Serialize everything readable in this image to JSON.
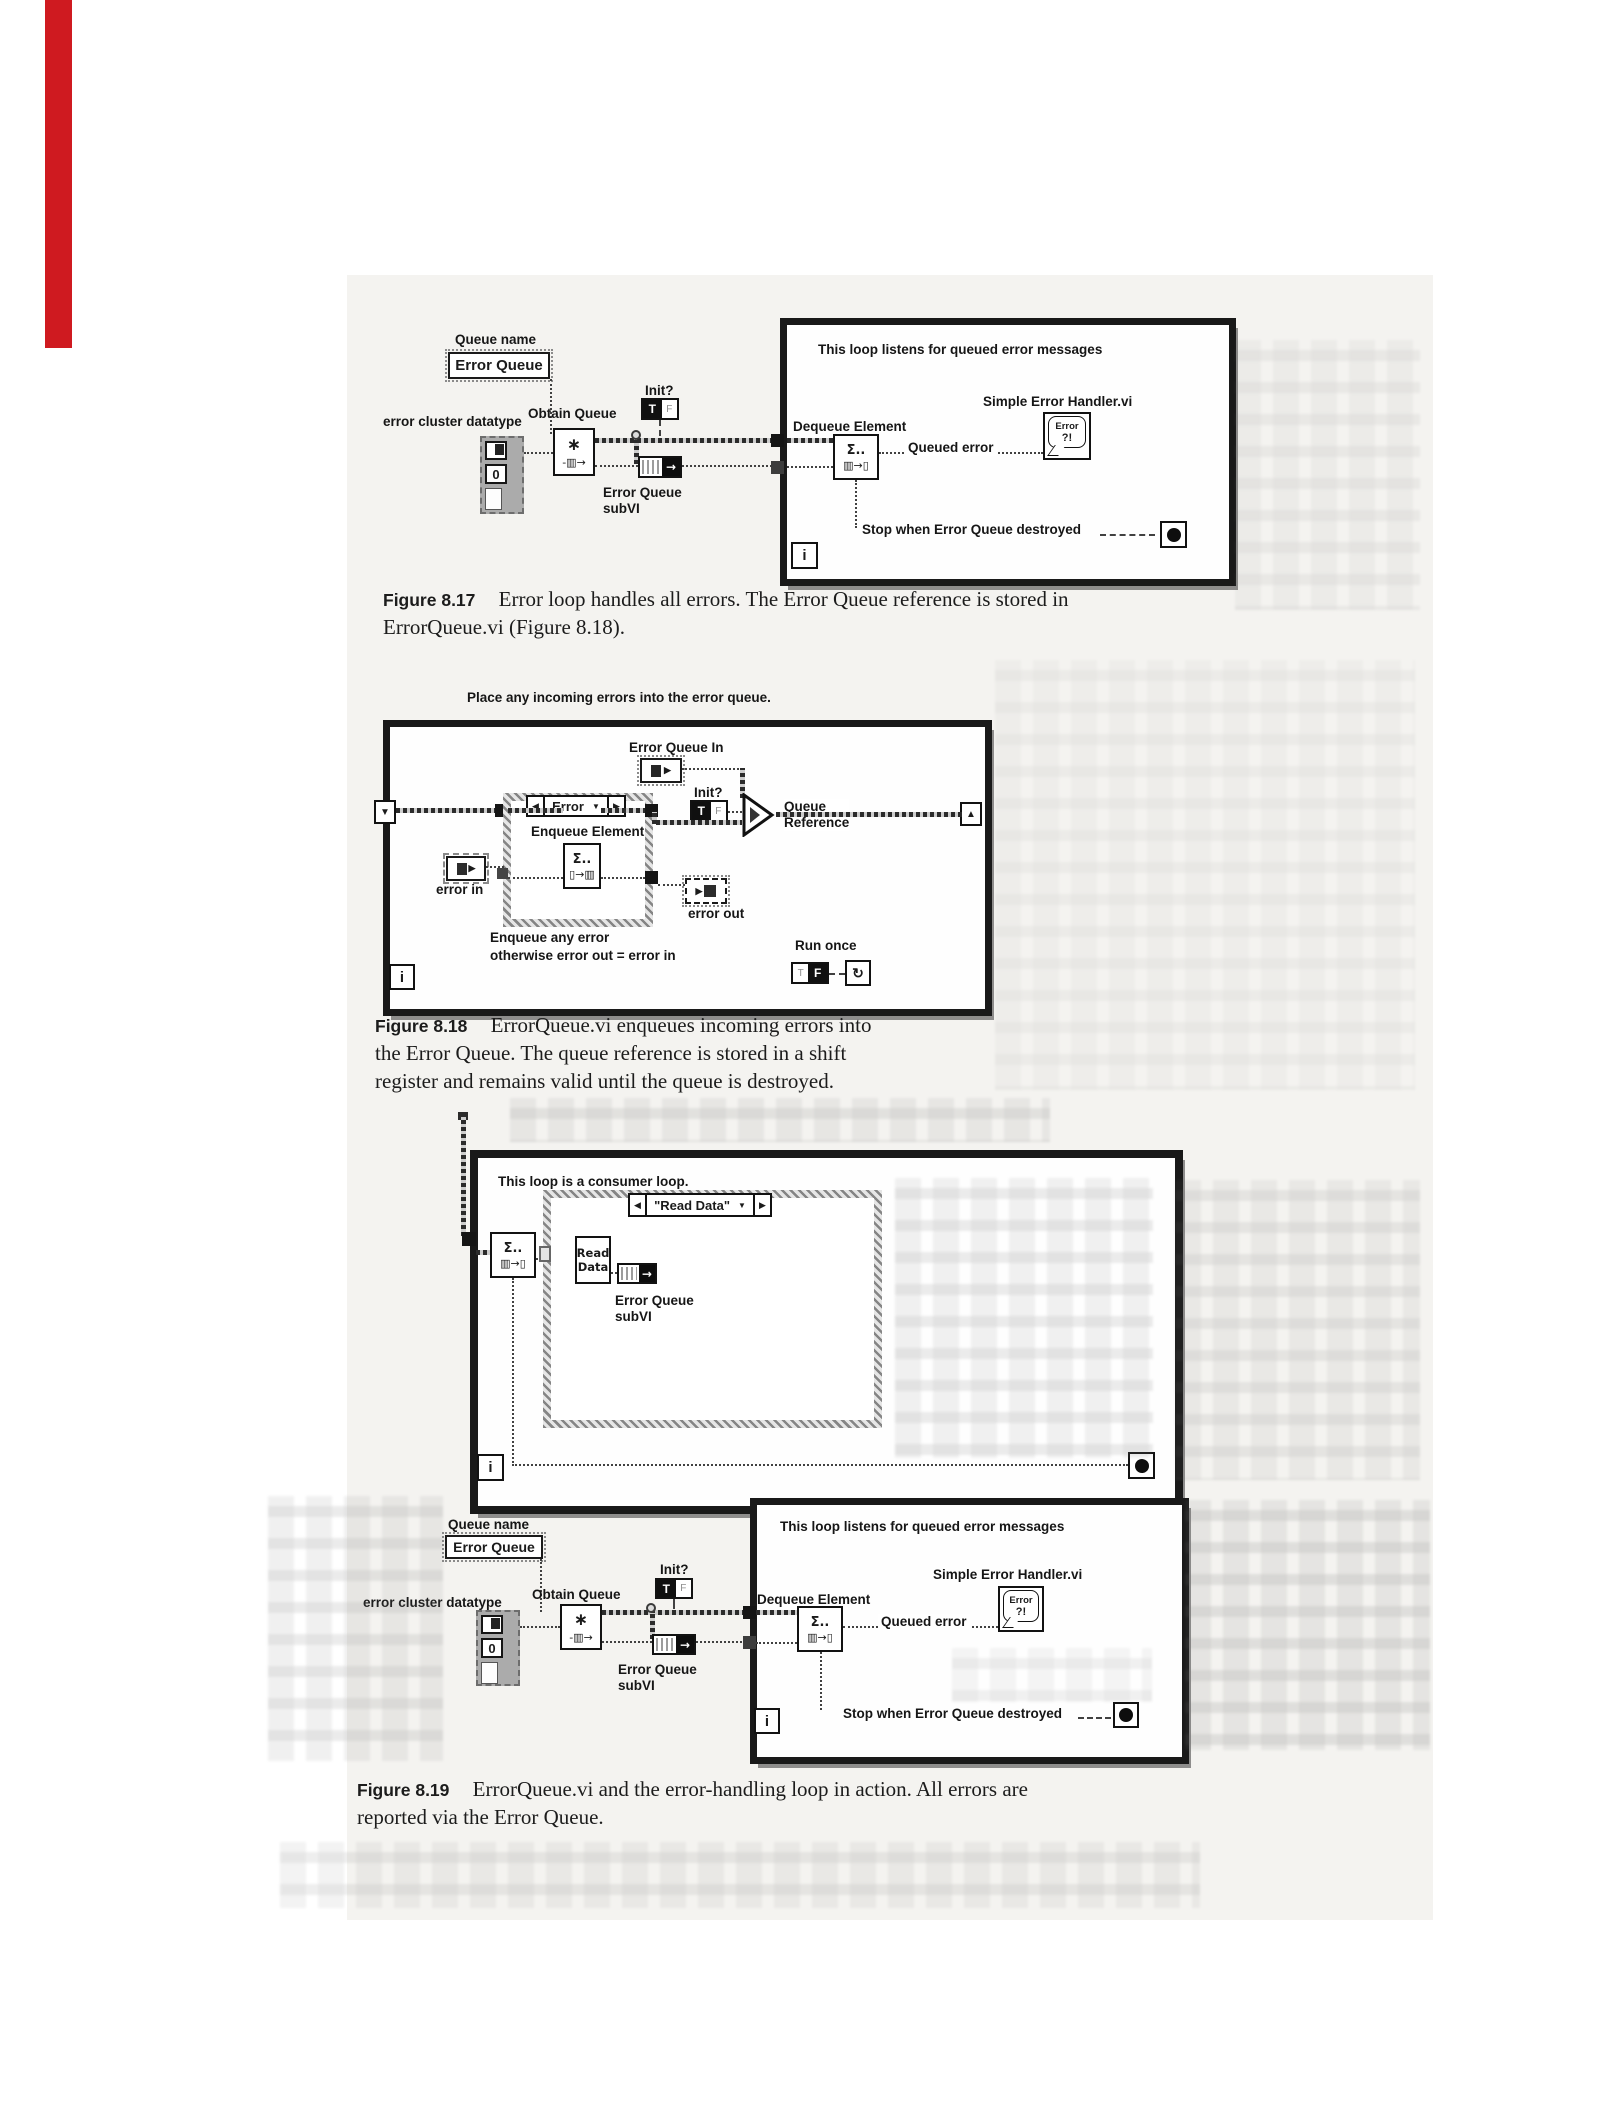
{
  "page": {
    "scan_tint": "#f4f3f0",
    "red_strip_color": "#cf1a20"
  },
  "icons": {
    "shift_down": "▼",
    "shift_up": "▲",
    "case_prev": "◀",
    "case_next": "▶",
    "dropdown": "▼",
    "stop_dot": "",
    "run_once_arrow": "↻",
    "burst": "∗",
    "queue_glyph": "-▥→",
    "hourglass": "Σ..",
    "dequeue_glyph": "▥→▯",
    "enqueue_glyph": "▯→▥",
    "subvi_arrow": "→",
    "t": "T",
    "f": "F"
  },
  "fig17": {
    "queue_name_label": "Queue name",
    "queue_name_value": "Error Queue",
    "error_cluster_label": "error cluster datatype",
    "cluster_value": "0",
    "obtain_queue_label": "Obtain Queue",
    "init_label": "Init?",
    "subvi_label_1": "Error Queue",
    "subvi_label_2": "subVI",
    "loop_comment": "This loop listens for queued error messages",
    "handler_label": "Simple Error Handler.vi",
    "handler_icon_1": "Error",
    "handler_icon_2": "?!",
    "dequeue_label": "Dequeue Element",
    "queued_error_label": "Queued error",
    "stop_label": "Stop when Error Queue destroyed",
    "iteration_label": "i",
    "caption": {
      "tag": "Figure 8.17",
      "line1": "Error loop handles all errors. The Error Queue reference is stored in",
      "line2": "ErrorQueue.vi (Figure 8.18)."
    }
  },
  "fig18": {
    "comment": "Place any incoming errors into the error queue.",
    "eq_in_label": "Error Queue In",
    "init_label": "Init?",
    "queue_ref_1": "Queue",
    "queue_ref_2": "Reference",
    "case_selector": "Error",
    "enqueue_label": "Enqueue Element",
    "error_in_label": "error in",
    "error_out_label": "error out",
    "note_1": "Enqueue any error",
    "note_2": "otherwise error out = error in",
    "run_once_label": "Run once",
    "iteration_label": "i",
    "caption": {
      "tag": "Figure 8.18",
      "line1": "ErrorQueue.vi enqueues incoming errors into",
      "line2": "the Error Queue. The queue reference is stored in a shift",
      "line3": "register and remains valid until the queue is destroyed."
    }
  },
  "fig19": {
    "consumer_comment": "This loop is a consumer loop.",
    "case_selector": "\"Read Data\"",
    "read_data_1": "Read",
    "read_data_2": "Data",
    "subvi_label_1": "Error Queue",
    "subvi_label_2": "subVI",
    "queue_name_label": "Queue name",
    "queue_name_value": "Error Queue",
    "error_cluster_label": "error cluster datatype",
    "cluster_value": "0",
    "obtain_queue_label": "Obtain Queue",
    "init_label": "Init?",
    "loop_comment": "This loop listens for queued error messages",
    "handler_label": "Simple Error Handler.vi",
    "handler_icon_1": "Error",
    "handler_icon_2": "?!",
    "dequeue_label": "Dequeue Element",
    "queued_error_label": "Queued error",
    "stop_label": "Stop when Error Queue destroyed",
    "iteration_label": "i",
    "caption": {
      "tag": "Figure 8.19",
      "line1": "ErrorQueue.vi and the error-handling loop in action. All errors are",
      "line2": "reported via the Error Queue."
    }
  }
}
